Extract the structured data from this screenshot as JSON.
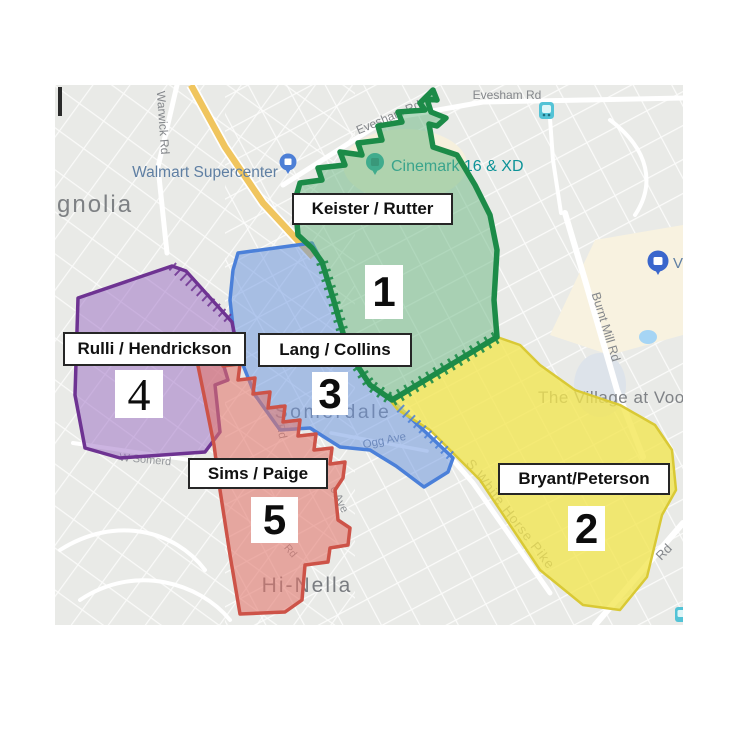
{
  "territories": [
    {
      "number": "1",
      "owners": "Keister / Rutter",
      "color": "#1c8b48"
    },
    {
      "number": "2",
      "owners": "Bryant/Peterson",
      "color": "#d9c935"
    },
    {
      "number": "3",
      "owners": "Lang / Collins",
      "color": "#4b80d9"
    },
    {
      "number": "4",
      "owners": "Rulli / Hendrickson",
      "color": "#6e3392"
    },
    {
      "number": "5",
      "owners": "Sims / Paige",
      "color": "#cd5348"
    }
  ],
  "towns": {
    "magnolia": "gnolia",
    "somerdale": "Somerdale",
    "hinella": "Hi-Nella",
    "voorhees": "The Village at Voo"
  },
  "pois": {
    "walmart": "Walmart Supercenter",
    "cinemark": "Cinemark 16 & XD",
    "voorhees_store": "V"
  },
  "roads": {
    "evesham_h": "Evesham Rd",
    "evesham_r": "Evesham Rd",
    "warwick": "Warwick Rd",
    "burnt_mill": "Burnt Mill Rd",
    "white_horse_pike": "S White Horse Pike",
    "white_horse_rd": "Rd",
    "w_somerdale": "W Somerd",
    "ogg": "Ogg Ave",
    "red_rd": "Rd",
    "c_ave": "c Ave",
    "red_rd2": "Rd"
  }
}
